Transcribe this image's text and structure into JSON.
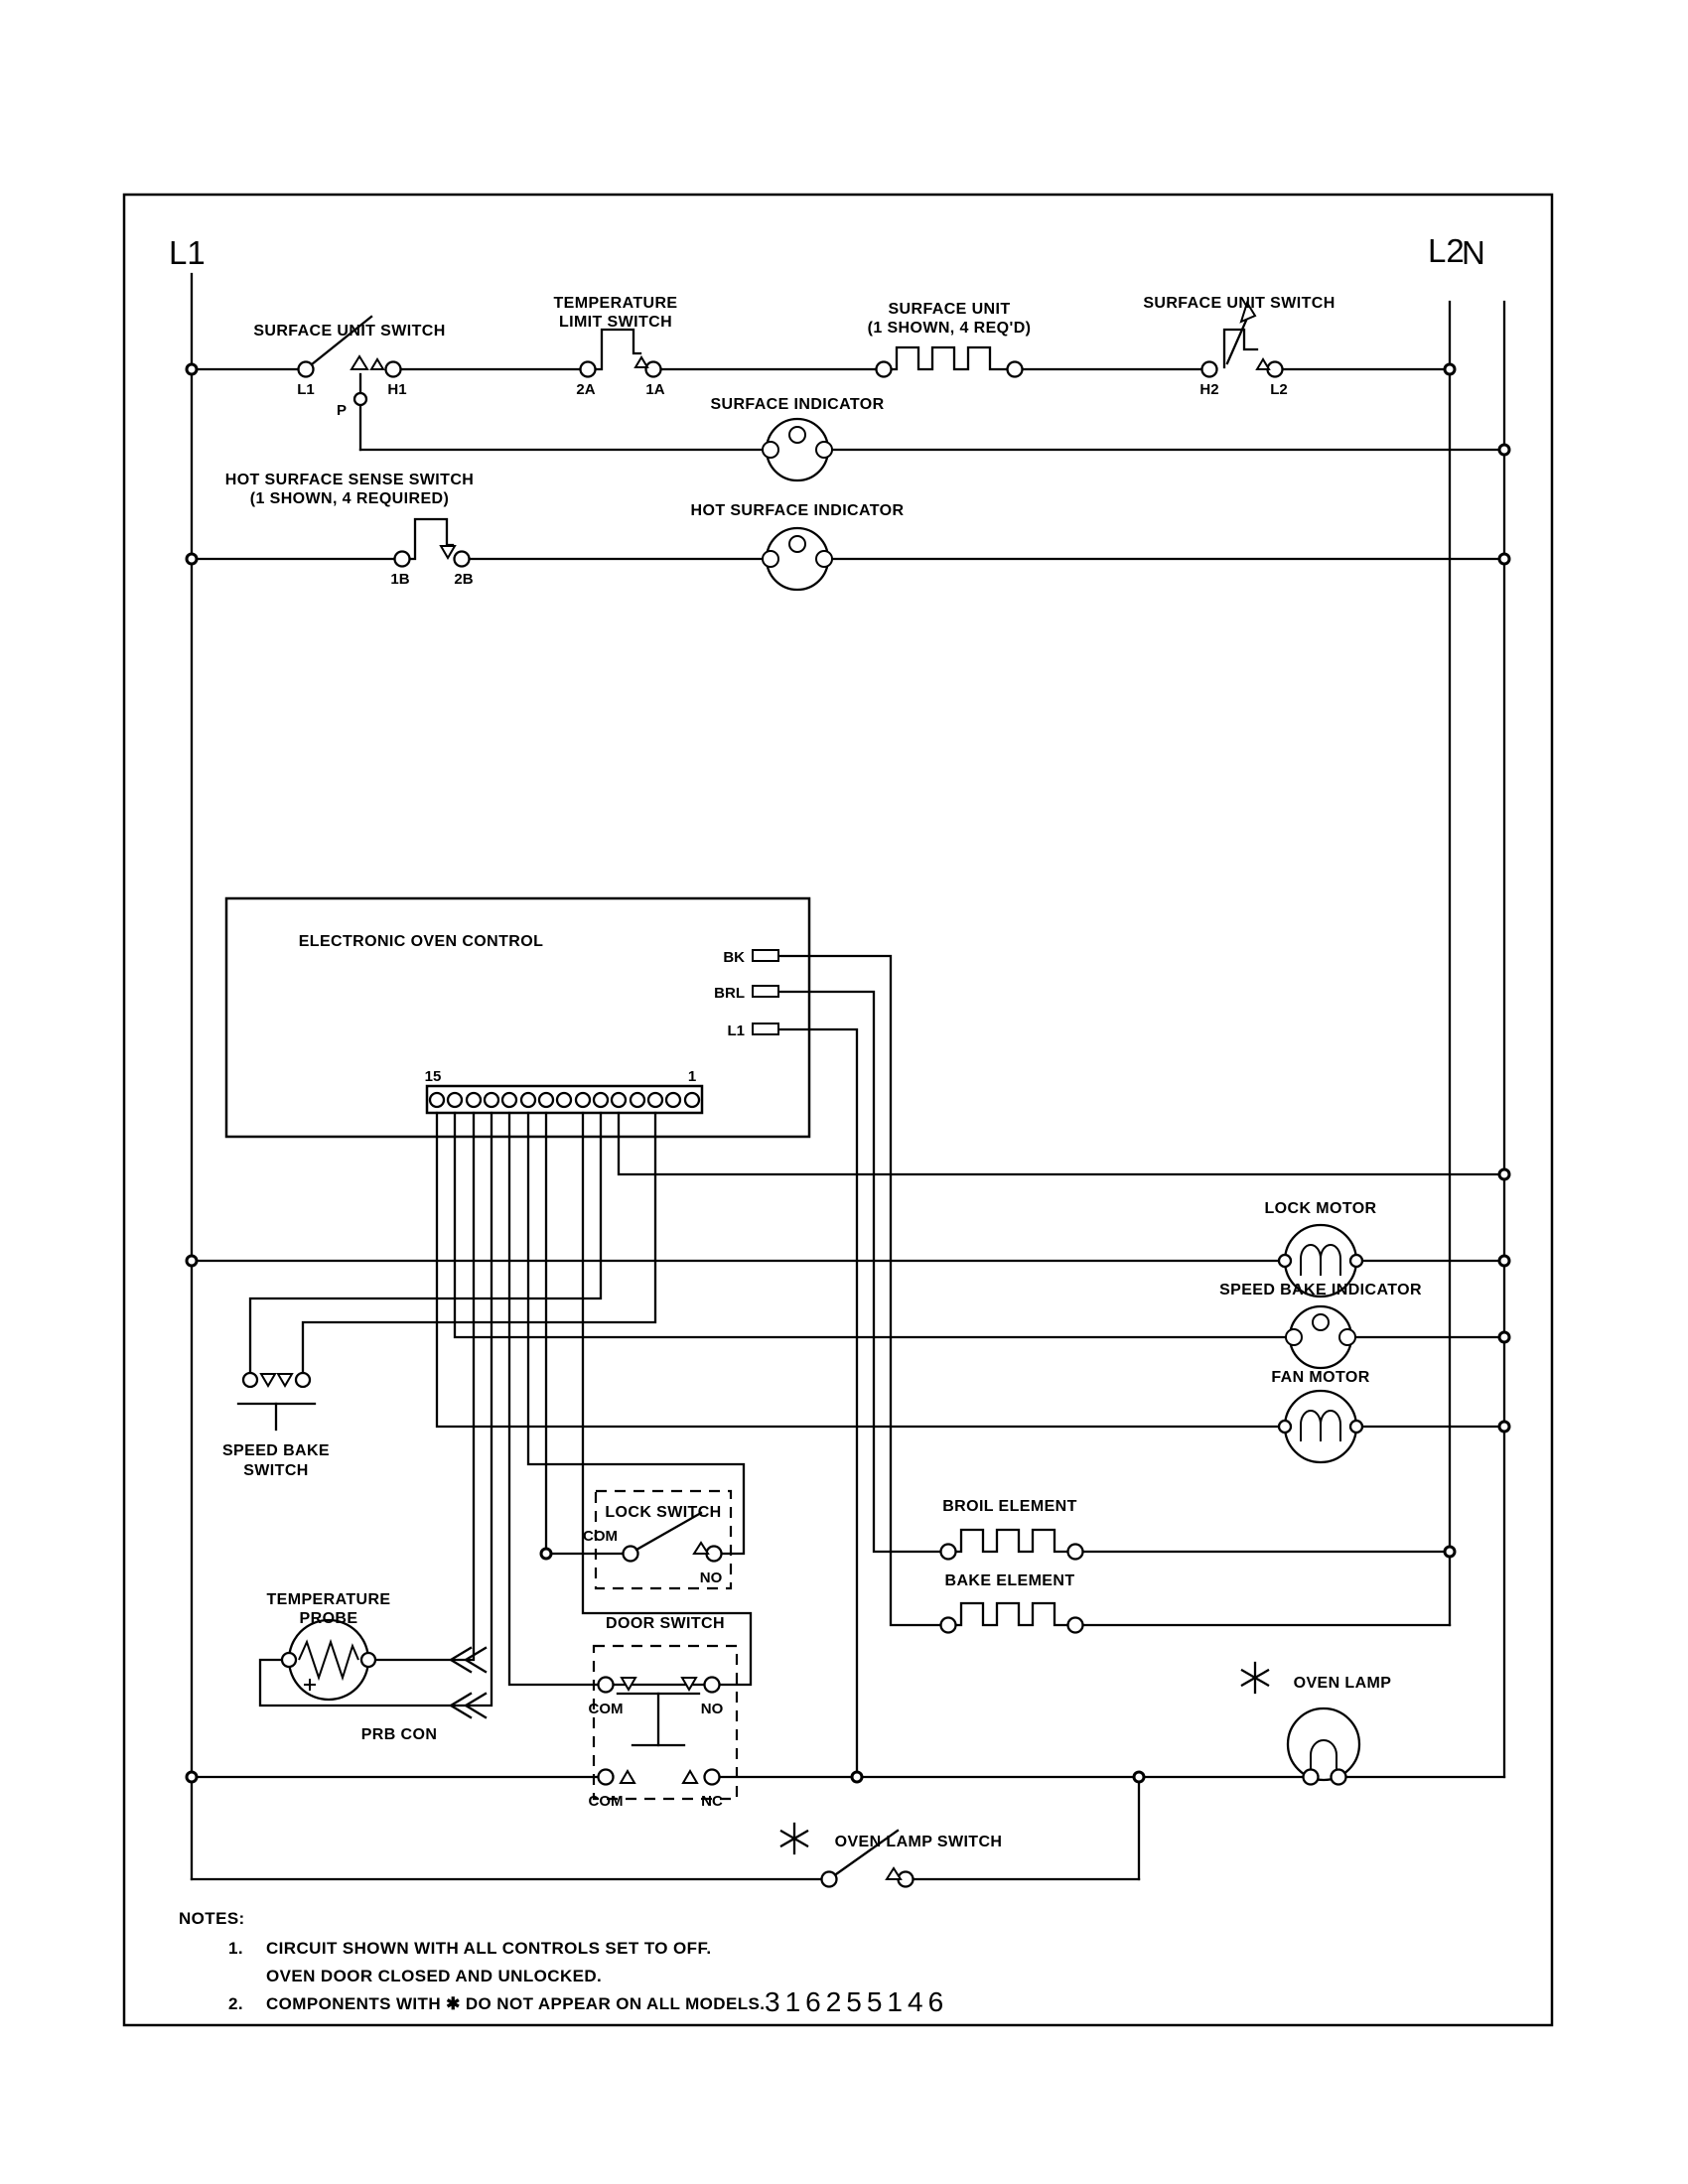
{
  "rails": {
    "l1": "L1",
    "l2": "L2",
    "n": "N"
  },
  "surface_unit_switch_left": {
    "label": "SURFACE UNIT SWITCH",
    "t1": "L1",
    "t2": "P",
    "t3": "H1"
  },
  "temperature_limit_switch": {
    "label1": "TEMPERATURE",
    "label2": "LIMIT SWITCH",
    "t1": "2A",
    "t2": "1A"
  },
  "surface_unit": {
    "label1": "SURFACE UNIT",
    "label2": "(1 SHOWN, 4 REQ'D)"
  },
  "surface_unit_switch_right": {
    "label": "SURFACE UNIT SWITCH",
    "t1": "H2",
    "t2": "L2"
  },
  "surface_indicator": {
    "label": "SURFACE INDICATOR"
  },
  "hot_surface_sense_switch": {
    "label1": "HOT SURFACE SENSE SWITCH",
    "label2": "(1 SHOWN, 4 REQUIRED)",
    "t1": "1B",
    "t2": "2B"
  },
  "hot_surface_indicator": {
    "label": "HOT SURFACE INDICATOR"
  },
  "eoc": {
    "label": "ELECTRONIC OVEN CONTROL",
    "pad1": "BK",
    "pad2": "BRL",
    "pad3": "L1",
    "strip_left": "15",
    "strip_right": "1"
  },
  "lock_motor": {
    "label": "LOCK MOTOR"
  },
  "speed_bake_indicator": {
    "label": "SPEED BAKE INDICATOR"
  },
  "fan_motor": {
    "label": "FAN MOTOR"
  },
  "speed_bake_switch": {
    "label1": "SPEED BAKE",
    "label2": "SWITCH"
  },
  "lock_switch": {
    "label": "LOCK SWITCH",
    "com": "COM",
    "no": "NO"
  },
  "door_switch": {
    "label": "DOOR SWITCH",
    "com_top": "COM",
    "no": "NO",
    "com_bottom": "COM",
    "nc": "NC"
  },
  "temperature_probe": {
    "label1": "TEMPERATURE",
    "label2": "PROBE",
    "connector_label": "PRB CON"
  },
  "broil_element": {
    "label": "BROIL ELEMENT"
  },
  "bake_element": {
    "label": "BAKE ELEMENT"
  },
  "oven_lamp": {
    "label": "OVEN LAMP"
  },
  "oven_lamp_switch": {
    "label": "OVEN LAMP SWITCH"
  },
  "notes": {
    "heading": "NOTES:",
    "item1_num": "1.",
    "item1_line1": "CIRCUIT SHOWN WITH ALL CONTROLS SET TO OFF.",
    "item1_line2": "OVEN DOOR CLOSED AND UNLOCKED.",
    "item2_num": "2.",
    "item2": "COMPONENTS WITH  ✱  DO NOT APPEAR ON ALL MODELS.",
    "part_number": "316255146"
  }
}
